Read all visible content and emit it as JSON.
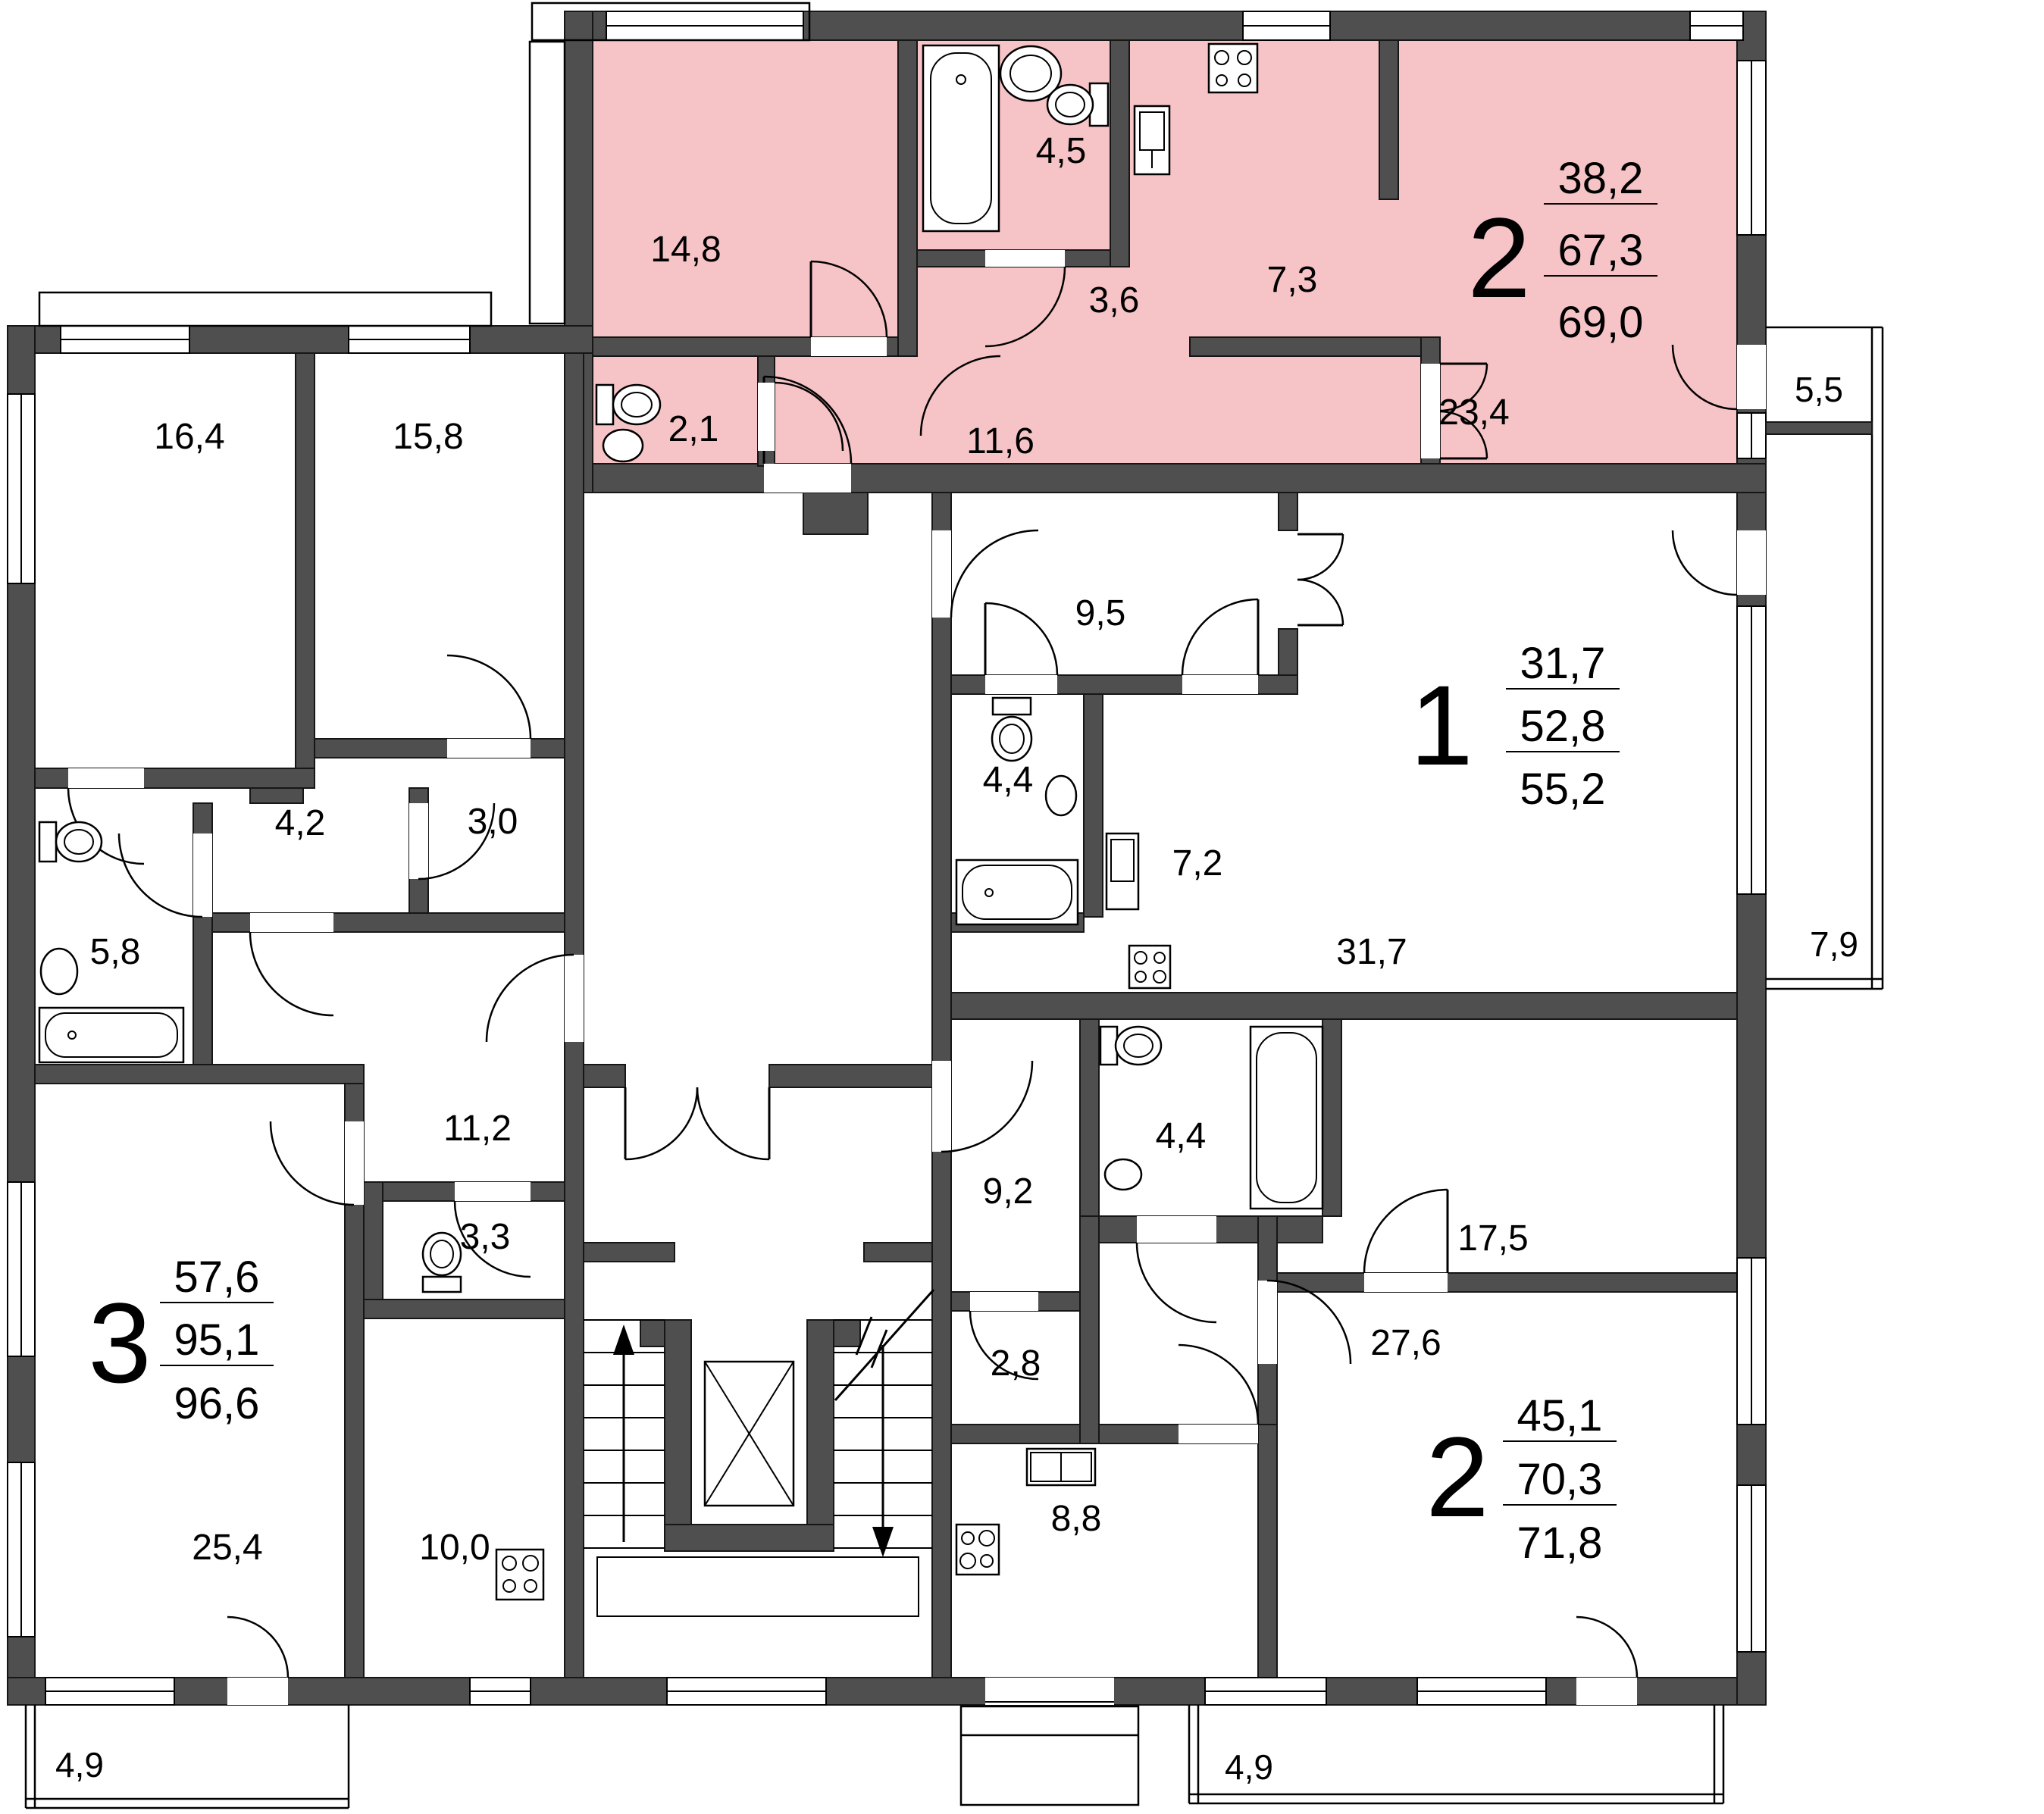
{
  "highlight_color": "#f6c3c6",
  "wall_color": "#4f4f4f",
  "apartments": [
    {
      "id": "apt-2-room-top",
      "number": "2",
      "highlighted": true,
      "areas": {
        "living": "38,2",
        "total": "67,3",
        "total_with_summer": "69,0"
      },
      "rooms": [
        {
          "name": "bedroom",
          "area": "14,8"
        },
        {
          "name": "bathroom",
          "area": "4,5"
        },
        {
          "name": "hall",
          "area": "3,6"
        },
        {
          "name": "kitchen",
          "area": "7,3"
        },
        {
          "name": "wc",
          "area": "2,1"
        },
        {
          "name": "corridor",
          "area": "11,6"
        },
        {
          "name": "living-room",
          "area": "23,4"
        }
      ]
    },
    {
      "id": "apt-1-room",
      "number": "1",
      "highlighted": false,
      "areas": {
        "living": "31,7",
        "total": "52,8",
        "total_with_summer": "55,2"
      },
      "rooms": [
        {
          "name": "corridor",
          "area": "9,5"
        },
        {
          "name": "bathroom",
          "area": "4,4"
        },
        {
          "name": "kitchen",
          "area": "7,2"
        },
        {
          "name": "living-room",
          "area": "31,7"
        }
      ]
    },
    {
      "id": "apt-3-room",
      "number": "3",
      "highlighted": false,
      "areas": {
        "living": "57,6",
        "total": "95,1",
        "total_with_summer": "96,6"
      },
      "rooms": [
        {
          "name": "bedroom",
          "area": "16,4"
        },
        {
          "name": "bedroom",
          "area": "15,8"
        },
        {
          "name": "hall",
          "area": "4,2"
        },
        {
          "name": "wardrobe",
          "area": "3,0"
        },
        {
          "name": "bathroom",
          "area": "5,8"
        },
        {
          "name": "corridor",
          "area": "11,2"
        },
        {
          "name": "wc",
          "area": "3,3"
        },
        {
          "name": "living-room",
          "area": "25,4"
        },
        {
          "name": "kitchen",
          "area": "10,0"
        }
      ]
    },
    {
      "id": "apt-2-room-bottom",
      "number": "2",
      "highlighted": false,
      "areas": {
        "living": "45,1",
        "total": "70,3",
        "total_with_summer": "71,8"
      },
      "rooms": [
        {
          "name": "corridor",
          "area": "9,2"
        },
        {
          "name": "bathroom",
          "area": "4,4"
        },
        {
          "name": "storage",
          "area": "2,8"
        },
        {
          "name": "bedroom",
          "area": "17,5"
        },
        {
          "name": "living-room",
          "area": "27,6"
        },
        {
          "name": "kitchen",
          "area": "8,8"
        }
      ]
    }
  ],
  "balconies": [
    {
      "name": "balcony-right-top",
      "area": "5,5"
    },
    {
      "name": "loggia-right",
      "area": "7,9"
    },
    {
      "name": "balcony-bottom-left",
      "area": "4,9"
    },
    {
      "name": "balcony-bottom-right",
      "area": "4,9"
    }
  ]
}
